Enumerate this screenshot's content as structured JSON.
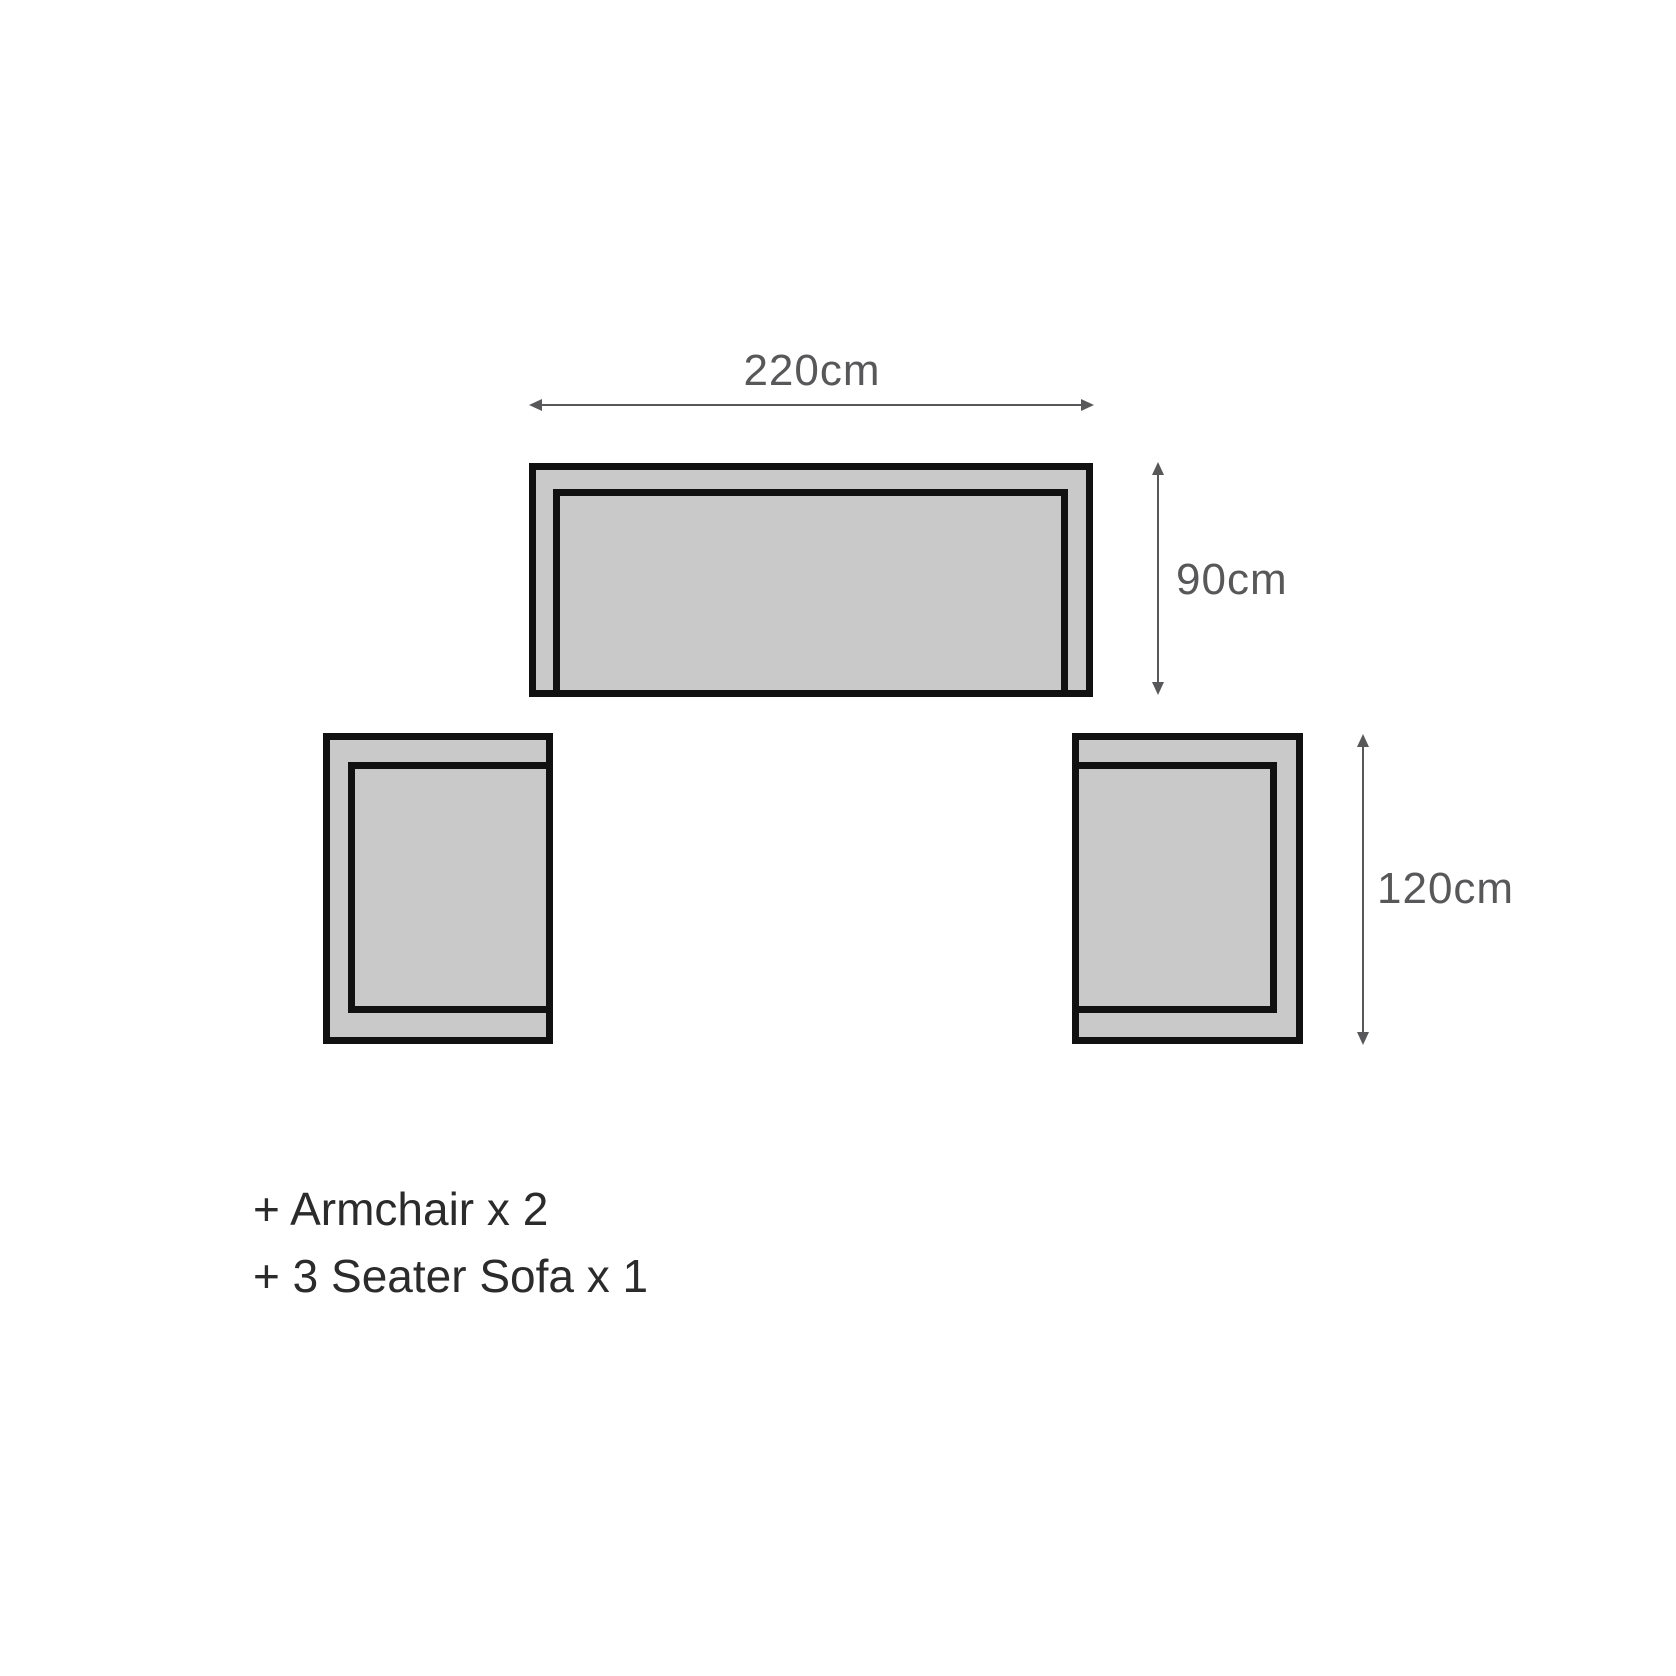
{
  "diagram": {
    "type": "furniture-dimension-diagram",
    "colors": {
      "background": "#ffffff",
      "shape_fill": "#c9c9c9",
      "shape_outline": "#111111",
      "dimension_color": "#58585a",
      "legend_text_color": "#2b2b2b"
    },
    "dimensions": {
      "sofa_width": "220cm",
      "sofa_depth": "90cm",
      "armchair_depth": "120cm"
    },
    "legend": {
      "items": [
        "+ Armchair x 2",
        "+ 3 Seater Sofa x 1"
      ]
    }
  }
}
